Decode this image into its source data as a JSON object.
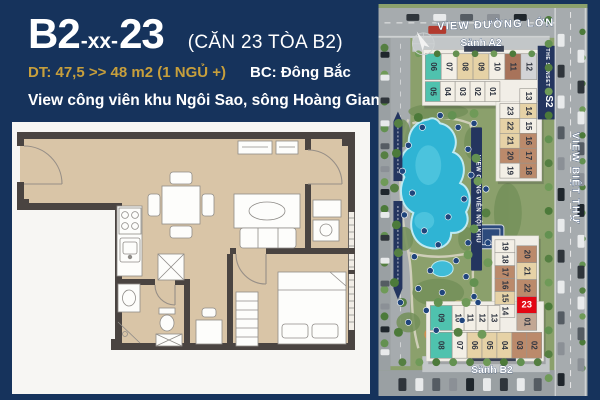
{
  "theme": {
    "bg": "#16335c",
    "gold": "#c79f3c",
    "navy_ribbon": "#24355f",
    "red": "#e30613"
  },
  "header": {
    "code_main": "B2",
    "code_sep": "-xx-",
    "code_unit": "23",
    "code_suffix": "(CĂN 23 TÒA B2)",
    "area_label": "DT: 47,5 >> 48 m2  (1 NGỦ +)",
    "direction_label": "BC:  Đông Bắc",
    "view_label": "View công viên khu Ngôi Sao, sông Hoàng Giang"
  },
  "map": {
    "top_road_label": "VIEW ĐƯỜNG LỚN",
    "right_road_label": "VIEW BIỆT THỰ",
    "park_ribbon_label": "VIEW CÔNG VIÊN NỘI KHU",
    "lobby_a2": "Sảnh A2",
    "lobby_b2": "Sảnh B2",
    "s2_band_line1": "THE SUNSET",
    "s2_band_line2": "S2",
    "highlighted_unit": "23",
    "palette": {
      "teal": "#4fc2ae",
      "cream": "#f3efe6",
      "tan": "#e6d2a6",
      "brown": "#bb8a6b",
      "darkbrown": "#a8735a",
      "gray": "#d2d3d6",
      "red": "#e30613",
      "graybrown": "#c2a794"
    },
    "towers": {
      "s2": {
        "rowA": [
          [
            "06",
            "teal"
          ],
          [
            "07",
            "cream"
          ],
          [
            "08",
            "tan"
          ],
          [
            "09",
            "tan"
          ],
          [
            "10",
            "cream"
          ],
          [
            "11",
            "darkbrown"
          ],
          [
            "12",
            "gray"
          ]
        ],
        "rowB": [
          [
            "05",
            "teal"
          ],
          [
            "04",
            "cream"
          ],
          [
            "03",
            "cream"
          ],
          [
            "02",
            "cream"
          ],
          [
            "01",
            "cream"
          ]
        ],
        "wingL": [
          [
            "23",
            "cream"
          ],
          [
            "22",
            "tan"
          ],
          [
            "21",
            "tan"
          ],
          [
            "20",
            "brown"
          ],
          [
            "19",
            "cream"
          ]
        ],
        "wingR": [
          [
            "13",
            "cream"
          ],
          [
            "14",
            "tan"
          ],
          [
            "15",
            "cream"
          ],
          [
            "16",
            "brown"
          ],
          [
            "17",
            "brown"
          ],
          [
            "18",
            "brown"
          ]
        ]
      },
      "b2": {
        "wingL": [
          [
            "19",
            "cream"
          ],
          [
            "18",
            "cream"
          ],
          [
            "17",
            "brown"
          ],
          [
            "16",
            "brown"
          ],
          [
            "15",
            "tan"
          ],
          [
            "14",
            "cream"
          ]
        ],
        "wingR": [
          [
            "20",
            "brown"
          ],
          [
            "21",
            "tan"
          ],
          [
            "22",
            "brown"
          ],
          [
            "23",
            "red"
          ],
          [
            "01",
            "graybrown"
          ]
        ],
        "rowMid": [
          [
            "09",
            "teal"
          ],
          [
            "10",
            "cream"
          ],
          [
            "11",
            "cream"
          ],
          [
            "12",
            "cream"
          ],
          [
            "13",
            "cream"
          ]
        ],
        "rowBottom": [
          [
            "08",
            "teal"
          ],
          [
            "07",
            "cream"
          ],
          [
            "06",
            "tan"
          ],
          [
            "05",
            "tan"
          ],
          [
            "04",
            "tan"
          ],
          [
            "03",
            "brown"
          ],
          [
            "02",
            "brown"
          ]
        ]
      }
    }
  }
}
